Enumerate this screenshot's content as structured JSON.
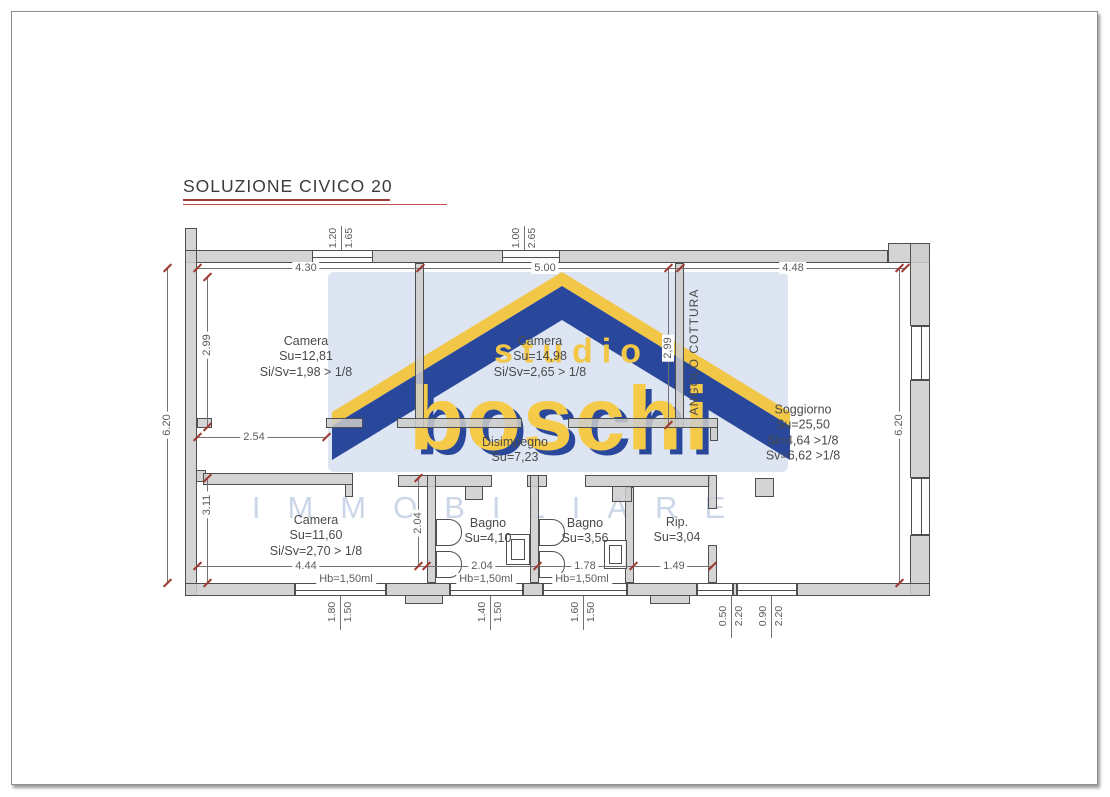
{
  "title": {
    "text": "SOLUZIONE CIVICO 20"
  },
  "watermark": {
    "studio": "studio",
    "brand": "boschi",
    "subtitle": "IMMOBILIARE"
  },
  "rooms": {
    "camera1": {
      "name": "Camera",
      "su": "Su=12,81",
      "ratio": "Si/Sv=1,98 > 1/8"
    },
    "camera2": {
      "name": "Camera",
      "su": "Su=14,98",
      "ratio": "Si/Sv=2,65 > 1/8"
    },
    "angolo_cottura": {
      "name": "ANGOLO COTTURA"
    },
    "soggiorno": {
      "name": "Soggiorno",
      "su": "Su=25,50",
      "si": "Si=4,64 >1/8",
      "sv": "Sv=6,62 >1/8"
    },
    "disimpegno": {
      "name": "Disimpegno",
      "su": "Su=7,23"
    },
    "camera3": {
      "name": "Camera",
      "su": "Su=11,60",
      "ratio": "Si/Sv=2,70 > 1/8"
    },
    "bagno1": {
      "name": "Bagno",
      "su": "Su=4,10"
    },
    "bagno2": {
      "name": "Bagno",
      "su": "Su=3,56"
    },
    "ripostiglio": {
      "name": "Rip.",
      "su": "Su=3,04"
    }
  },
  "dims": {
    "top_spans": [
      "4.30",
      "5.00",
      "4.48"
    ],
    "left_outer": "6.20",
    "left_upper": "2.99",
    "left_lower": "3.11",
    "mid_vertical": "2,99",
    "right_outer": "6.20",
    "hall_width": "2.54",
    "bath_depth": "2.04",
    "bottom_spans": [
      "4.44",
      "2.04",
      "1.78",
      "1.49"
    ],
    "hb": [
      "Hb=1,50ml",
      "Hb=1,50ml",
      "Hb=1,50ml"
    ],
    "top_windows": [
      {
        "w": "1.20",
        "h": "1.65"
      },
      {
        "w": "1.00",
        "h": "2.65"
      }
    ],
    "bottom_windows": [
      {
        "w": "1.80",
        "h": "1.50"
      },
      {
        "w": "1.40",
        "h": "1.50"
      },
      {
        "w": "1.60",
        "h": "1.50"
      },
      {
        "w": "0.50",
        "h": "2.20"
      },
      {
        "w": "0.90",
        "h": "2.20"
      }
    ]
  },
  "colors": {
    "accent_red": "#a43931",
    "brand_navy": "#1e3f97",
    "brand_yellow": "#f2c43d",
    "watermark_bg": "#dce4f2",
    "wall_fill": "#cccccc",
    "tick_red": "#9c3a31"
  }
}
